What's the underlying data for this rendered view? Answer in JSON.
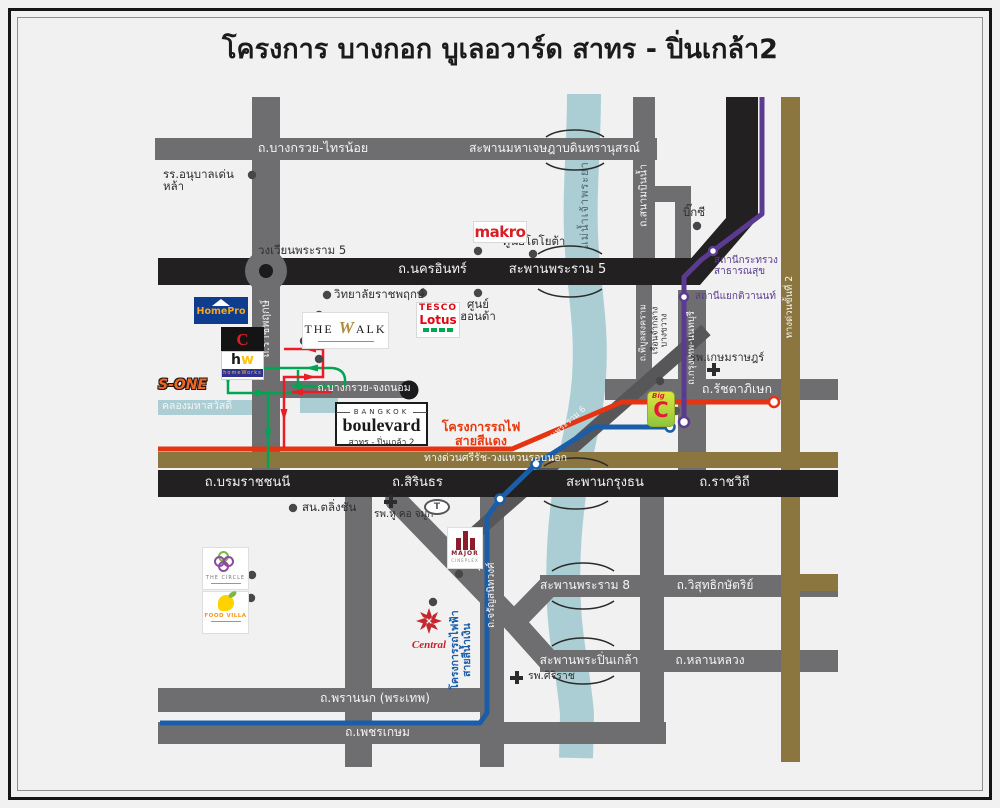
{
  "title": "โครงการ บางกอก บูเลอวาร์ด สาทร - ปิ่นเกล้า2",
  "colors": {
    "background": "#f1f1f2",
    "road_gray": "#6e6e70",
    "road_black": "#222021",
    "expressway_gold": "#8b763f",
    "river": "#abced5",
    "red_line": "#e63312",
    "blue_line": "#1a5da8",
    "purple_line": "#5b3b91",
    "route_green": "#00a551",
    "route_red": "#ec1c24"
  },
  "labels": {
    "bangkruai_sainoi": "ถ.บางกรวย-ไทรน้อย",
    "jetsada": "สะพานมหาเจษฎาบดินทรานุสรณ์",
    "denla": "รร.อนุบาลเด่นหล้า",
    "wongwian": "วงเวียนพระราม 5",
    "nakhon_in": "ถ.นครอินทร์",
    "rama5_bridge": "สะพานพระราม 5",
    "sanambin_nam": "ถ.สนามบินน้ำ",
    "maenam": "แม่น้ำเจ้าพระยา",
    "toyota_center": "ศูนย์โตโยต้า",
    "bigc_poi": "บิ๊กซี",
    "station_health1": "สถานีกระทรวง",
    "station_health2": "สาธารณสุข",
    "station_tiwanon": "สถานีแยกติวานนท์",
    "expressway2": "ทางด่วนขั้นที่ 2",
    "rajapruek_college": "วิทยาลัยราชพฤกษ์",
    "rajapruek_road": "ถ.ราชพฤกษ์",
    "honda1": "ศูนย์",
    "honda2": "ฮอนด้า",
    "chongthanom": "ถ.บางกรวย-จงถนอม",
    "canal": "คลองมหาสวัสดิ์",
    "redline1": "โครงการรถไฟ",
    "redline2": "สายสีแดง",
    "sirat": "ทางด่วนศรีรัช-วงแหวนรอบนอก",
    "rama6_bridge": "สะพานพระราม 6",
    "ratchada": "ถ.รัชดาภิเษก",
    "ktnont": "ถ.กรุงเทพ-นนทบุรี",
    "piboon": "ถ.พิบูลสงคราม",
    "bangkwang1": "เรือนจำกลาง",
    "bangkwang2": "บางขวาง",
    "kasem": "รพ.เกษมราษฎร์",
    "boromrat": "ถ.บรมราชชนนี",
    "sirinthon": "ถ.สิรินธร",
    "krungthon": "สะพานกรุงธน",
    "ratchawithi": "ถ.ราชวิถี",
    "taling_chan": "สน.ตลิ่งชัน",
    "ent_hospital": "รพ.หู คอ จมูก",
    "jaran": "ถ.จรัญสนิทวงศ์",
    "blueline1": "โครงการรถไฟฟ้า",
    "blueline2": "สายสีน้ำเงิน",
    "rama8_bridge": "สะพานพระราม 8",
    "wisut": "ถ.วิสุทธิกษัตริย์",
    "pinklao_bridge": "สะพานพระปิ่นเกล้า",
    "lanluang": "ถ.หลานหลวง",
    "siriraj": "รพ.ศิริราช",
    "prannok": "ถ.พรานนก (พระเทพ)",
    "phetkasem": "ถ.เพชรเกษม"
  },
  "logos": {
    "makro": "makro",
    "tesco1": "TESCO",
    "tesco2": "Lotus",
    "homepro": "HomePro",
    "cblack": "C",
    "hw2": "homeWorks",
    "sone": "S-ONE",
    "walk1": "THE",
    "walk2": "W",
    "walk3": "ALK",
    "bv_top": "BANGKOK",
    "bv_main": "boulevard",
    "bv_sub": "สาทร - ปิ่นเกล้า 2",
    "bigc_small": "Big",
    "bigc": "C",
    "major": "MAJOR",
    "major_sub": "CINEPLEX",
    "central": "Central",
    "circle": "THE CIRCLE",
    "foodvilla": "FOOD VILLA",
    "toyota": "T"
  }
}
